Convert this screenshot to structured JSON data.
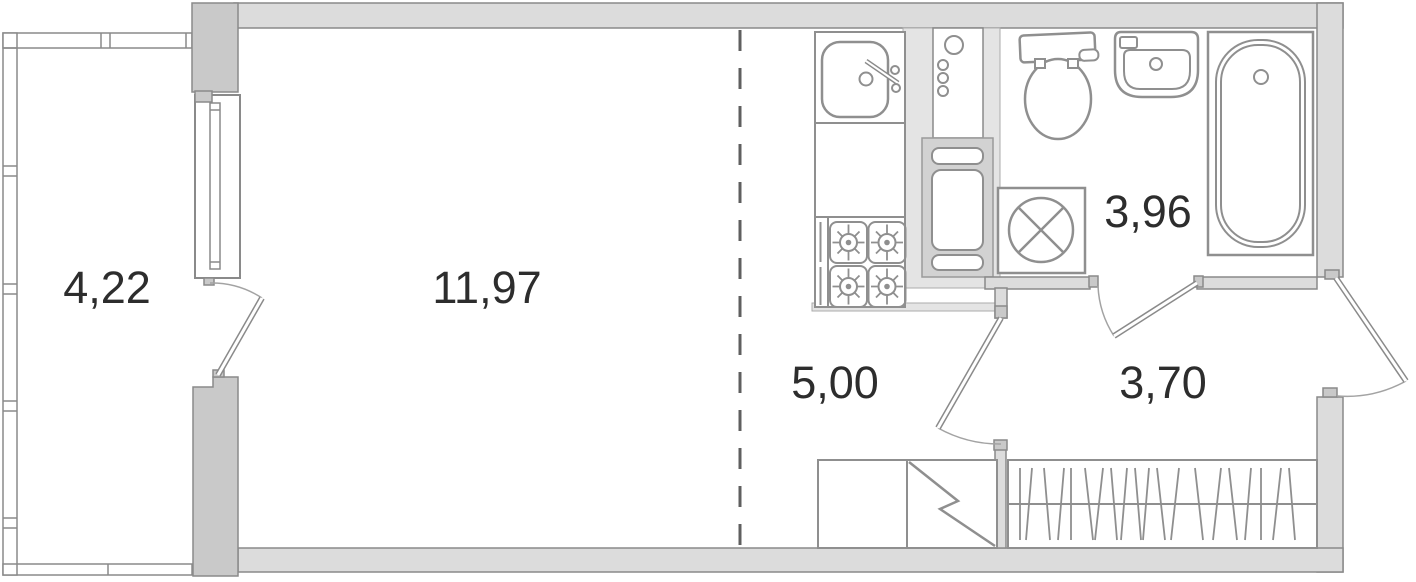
{
  "plan": {
    "rooms": [
      {
        "id": "balcony",
        "area": "4,22"
      },
      {
        "id": "living-room",
        "area": "11,97"
      },
      {
        "id": "kitchen",
        "area": "5,00"
      },
      {
        "id": "bathroom",
        "area": "3,96"
      },
      {
        "id": "hallway",
        "area": "3,70"
      }
    ],
    "fixtures": [
      "kitchen-sink-icon",
      "cooktop-4-burner-icon",
      "pipe-riser-icon",
      "ventilation-shaft-icon",
      "toilet-icon",
      "washbasin-icon",
      "bathtub-icon",
      "washing-machine-icon",
      "storage-closet-icon",
      "wardrobe-hangers-icon"
    ],
    "doors": [
      "balcony-door",
      "kitchen-door",
      "bathroom-door",
      "entry-door"
    ],
    "colors": {
      "background": "#ffffff",
      "exterior_wall": "#dcdcdc",
      "pier": "#c9c9c9",
      "shaft": "#d2d2d2",
      "band": "#e4e4e4",
      "outline": "#8a8a8a",
      "fixture_line": "#8f8f8f",
      "dash_line": "#5f5f5f",
      "label_text": "#2d2d2d"
    }
  }
}
